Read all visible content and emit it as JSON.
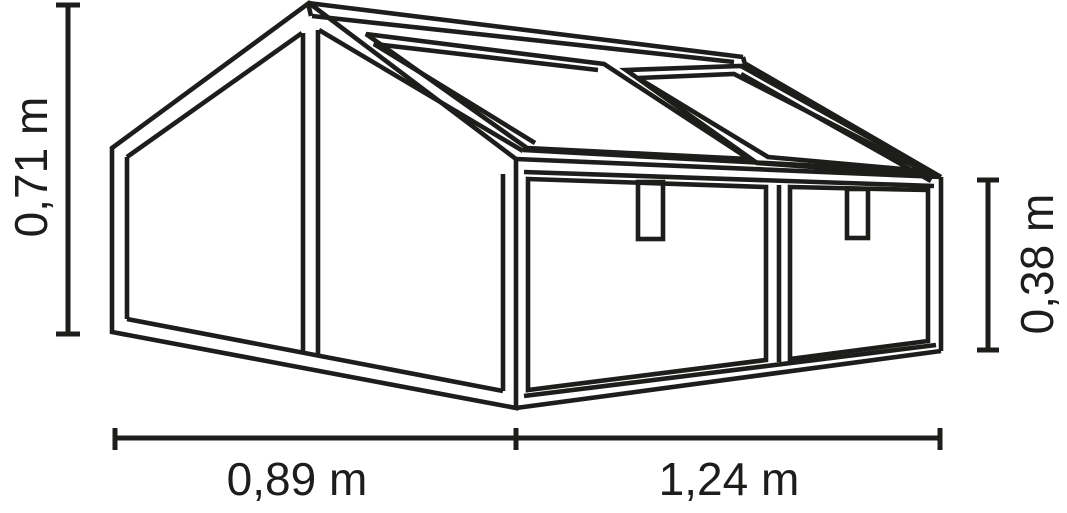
{
  "diagram": {
    "type": "technical-dimension-drawing",
    "subject": "Cold frame mini greenhouse, perspective line drawing with gable roof, two roof window sashes, front wall with two panels and two latch tabs",
    "colors": {
      "line": "#1d1d1b",
      "background": "#ffffff"
    },
    "dimensions": {
      "total_height": {
        "label": "0,71 m",
        "value_m": 0.71,
        "position": "left",
        "orientation": "vertical"
      },
      "front_height": {
        "label": "0,38 m",
        "value_m": 0.38,
        "position": "right",
        "orientation": "vertical"
      },
      "depth": {
        "label": "0,89 m",
        "value_m": 0.89,
        "position": "bottom-left",
        "orientation": "horizontal"
      },
      "width": {
        "label": "1,24 m",
        "value_m": 1.24,
        "position": "bottom-right",
        "orientation": "horizontal"
      }
    }
  }
}
